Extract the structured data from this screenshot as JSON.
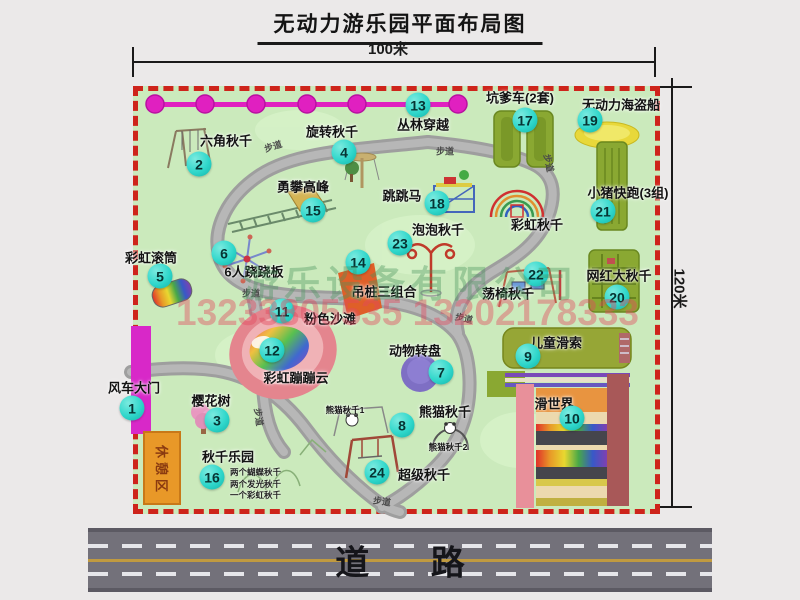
{
  "title": "无动力游乐园平面布局图",
  "dimensions": {
    "width": "100米",
    "height": "120米"
  },
  "bottom_road": {
    "label": "道 路"
  },
  "watermark": {
    "company": "游乐设备有限公司",
    "phone": "13233805535 13202178333"
  },
  "colors": {
    "park_green": "#cbeabc",
    "border_red": "#ce241b",
    "badge_cyan": "#2fd7cb",
    "path_gray": "#a6a6a6",
    "gate_magenta": "#d828c8",
    "zipline_magenta": "#e020c0",
    "rest_area_orange": "#e89828",
    "road_gray": "#73717a",
    "equipment_olive": "#8aa832",
    "pirate_yellow": "#e8d83a",
    "beach_pink": "#e8909a",
    "turntable_purple": "#7e6fc4"
  },
  "park": {
    "path_label": "步道",
    "rest_area_label": "休憩区",
    "attractions": [
      {
        "num": 1,
        "name": "风车大门",
        "bx": 132,
        "by": 408,
        "lx": 134,
        "ly": 387
      },
      {
        "num": 2,
        "name": "六角秋千",
        "bx": 199,
        "by": 164,
        "lx": 226,
        "ly": 140
      },
      {
        "num": 3,
        "name": "樱花树",
        "bx": 217,
        "by": 420,
        "lx": 211,
        "ly": 400
      },
      {
        "num": 4,
        "name": "旋转秋千",
        "bx": 344,
        "by": 152,
        "lx": 332,
        "ly": 131
      },
      {
        "num": 5,
        "name": "彩虹滚筒",
        "bx": 160,
        "by": 276,
        "lx": 151,
        "ly": 257
      },
      {
        "num": 6,
        "name": "6人跷跷板",
        "bx": 224,
        "by": 253,
        "lx": 254,
        "ly": 271
      },
      {
        "num": 7,
        "name": "动物转盘",
        "bx": 441,
        "by": 372,
        "lx": 415,
        "ly": 350
      },
      {
        "num": 8,
        "name": "熊猫秋千",
        "bx": 402,
        "by": 425,
        "lx": 445,
        "ly": 411
      },
      {
        "num": 9,
        "name": "儿童滑索",
        "bx": 528,
        "by": 356,
        "lx": 556,
        "ly": 342
      },
      {
        "num": 10,
        "name": "滑世界",
        "bx": 572,
        "by": 418,
        "lx": 554,
        "ly": 403
      },
      {
        "num": 11,
        "name": "粉色沙滩",
        "bx": 282,
        "by": 311,
        "lx": 330,
        "ly": 318
      },
      {
        "num": 12,
        "name": "彩虹蹦蹦云",
        "bx": 272,
        "by": 350,
        "lx": 296,
        "ly": 377
      },
      {
        "num": 13,
        "name": "丛林穿越",
        "bx": 418,
        "by": 105,
        "lx": 423,
        "ly": 124
      },
      {
        "num": 14,
        "name": "吊桩三组合",
        "bx": 358,
        "by": 262,
        "lx": 384,
        "ly": 291
      },
      {
        "num": 15,
        "name": "勇攀高峰",
        "bx": 313,
        "by": 210,
        "lx": 303,
        "ly": 186
      },
      {
        "num": 16,
        "name": "秋千乐园",
        "bx": 212,
        "by": 477,
        "lx": 228,
        "ly": 456
      },
      {
        "num": 17,
        "name": "坑爹车(2套)",
        "bx": 525,
        "by": 120,
        "lx": 520,
        "ly": 97
      },
      {
        "num": 18,
        "name": "跳跳马",
        "bx": 437,
        "by": 203,
        "lx": 402,
        "ly": 195
      },
      {
        "num": 19,
        "name": "无动力海盗船",
        "bx": 590,
        "by": 120,
        "lx": 621,
        "ly": 104
      },
      {
        "num": 20,
        "name": "网红大秋千",
        "bx": 617,
        "by": 297,
        "lx": 619,
        "ly": 275
      },
      {
        "num": 21,
        "name": "小猪快跑(3组)",
        "bx": 603,
        "by": 211,
        "lx": 628,
        "ly": 192
      },
      {
        "num": 22,
        "name": "荡椅秋千",
        "bx": 536,
        "by": 274,
        "lx": 508,
        "ly": 293
      },
      {
        "num": 23,
        "name": "泡泡秋千",
        "bx": 400,
        "by": 243,
        "lx": 438,
        "ly": 229
      },
      {
        "num": 24,
        "name": "超级秋千",
        "bx": 377,
        "by": 472,
        "lx": 424,
        "ly": 474
      }
    ],
    "extra_labels": [
      {
        "name": "彩虹秋千",
        "lx": 537,
        "ly": 224
      },
      {
        "name": "熊猫秋千1",
        "lx": 345,
        "ly": 410,
        "small": true
      },
      {
        "name": "熊猫秋千2",
        "lx": 448,
        "ly": 447,
        "small": true
      }
    ],
    "swing_park_details": {
      "x": 230,
      "y": 467,
      "lines": [
        "两个蝴蝶秋千",
        "两个发光秋千",
        "一个彩虹秋千"
      ]
    }
  }
}
